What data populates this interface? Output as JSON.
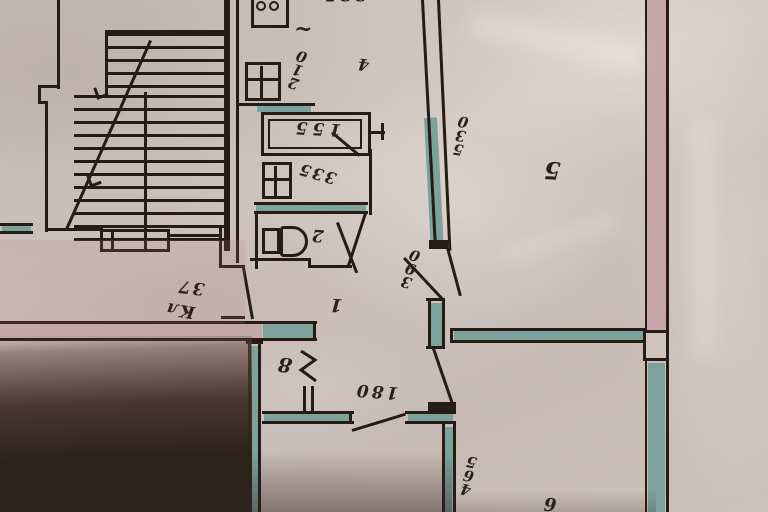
{
  "document": {
    "type": "Scanned BTI apartment floor plan photograph, drawing appears rotated 180 degrees",
    "paper_color": "#cbc0ba",
    "ink_color": "#251c15",
    "bearing_wall_color": "#7ca29b",
    "partition_fill_color": "#c3a7aa",
    "shadow_color": "#2e221c"
  },
  "labels": {
    "room_hall": "1",
    "room_wc": "2",
    "room_kitchen": "4",
    "room_5": "5",
    "room_6": "6",
    "room_8": "8",
    "closet_name": "Кл",
    "closet_area": "37",
    "dim_kitchen": "210",
    "dim_bathtub": "155",
    "dim_bath": "335",
    "dim_hall_opening": "180",
    "dim_room5_wall": "530",
    "dim_hall_wall": "390",
    "dim_room6": "465",
    "dim_top_partial": "335",
    "floor_squiggle": "~"
  }
}
